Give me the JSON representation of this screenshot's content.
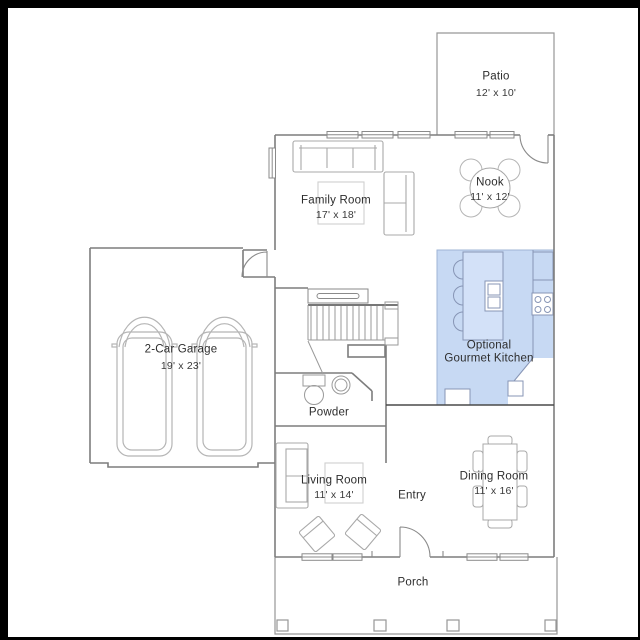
{
  "title": "Floor plan",
  "colors": {
    "background": "#000000",
    "paper": "#ffffff",
    "kitchen_highlight": "#c7d9f3",
    "kitchen_island": "#d3e1f8",
    "wall": "#7d7d7d",
    "text": "#2d2d2d"
  },
  "rooms": [
    {
      "name": "Patio",
      "dims": "12' x 10'"
    },
    {
      "name": "Nook",
      "dims": "11' x 12'"
    },
    {
      "name": "Family Room",
      "dims": "17' x 18'"
    },
    {
      "line1": "Optional",
      "line2": "Gourmet Kitchen"
    },
    {
      "name": "2-Car Garage",
      "dims": "19' x 23'"
    },
    {
      "name": "Powder"
    },
    {
      "name": "Living Room",
      "dims": "11' x 14'"
    },
    {
      "name": "Entry"
    },
    {
      "name": "Dining Room",
      "dims": "11' x 16'"
    },
    {
      "name": "Porch"
    }
  ]
}
